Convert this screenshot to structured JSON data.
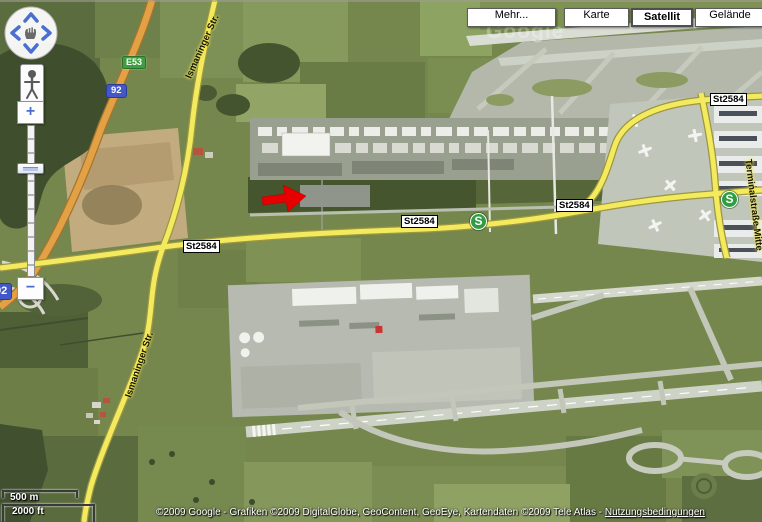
{
  "map_type_bar": {
    "mehr": "Mehr...",
    "karte": "Karte",
    "satellit": "Satellit",
    "gelaende": "Gelände"
  },
  "badges": {
    "euro_route": "E53",
    "bundesstrasse_92": "92",
    "st2584": "St2584"
  },
  "road_labels": {
    "ismaninger_str": "Ismaninger Str.",
    "terminalstrasse_mitte": "Terminalstraße Mitte"
  },
  "transit": {
    "sbahn_label": "S"
  },
  "zoom_control": {
    "zoom_in": "+",
    "zoom_out": "−"
  },
  "scale_bar": {
    "metric": "500 m",
    "imperial": "2000 ft"
  },
  "attribution": {
    "copyright": "©2009 Google - Grafiken ©2009 DigitalGlobe, GeoContent, GeoEye, Kartendaten ©2009 Tele Atlas - ",
    "terms_link": "Nutzungsbedingungen"
  },
  "watermark": "Google",
  "colors": {
    "road_yellow": "#f3ea5e",
    "motorway_orange": "#e2a144",
    "annotation_arrow_red": "#e80000",
    "sbahn_green": "#2f9e41",
    "badge_blue": "#4257c8",
    "badge_green": "#3f9e3f"
  }
}
